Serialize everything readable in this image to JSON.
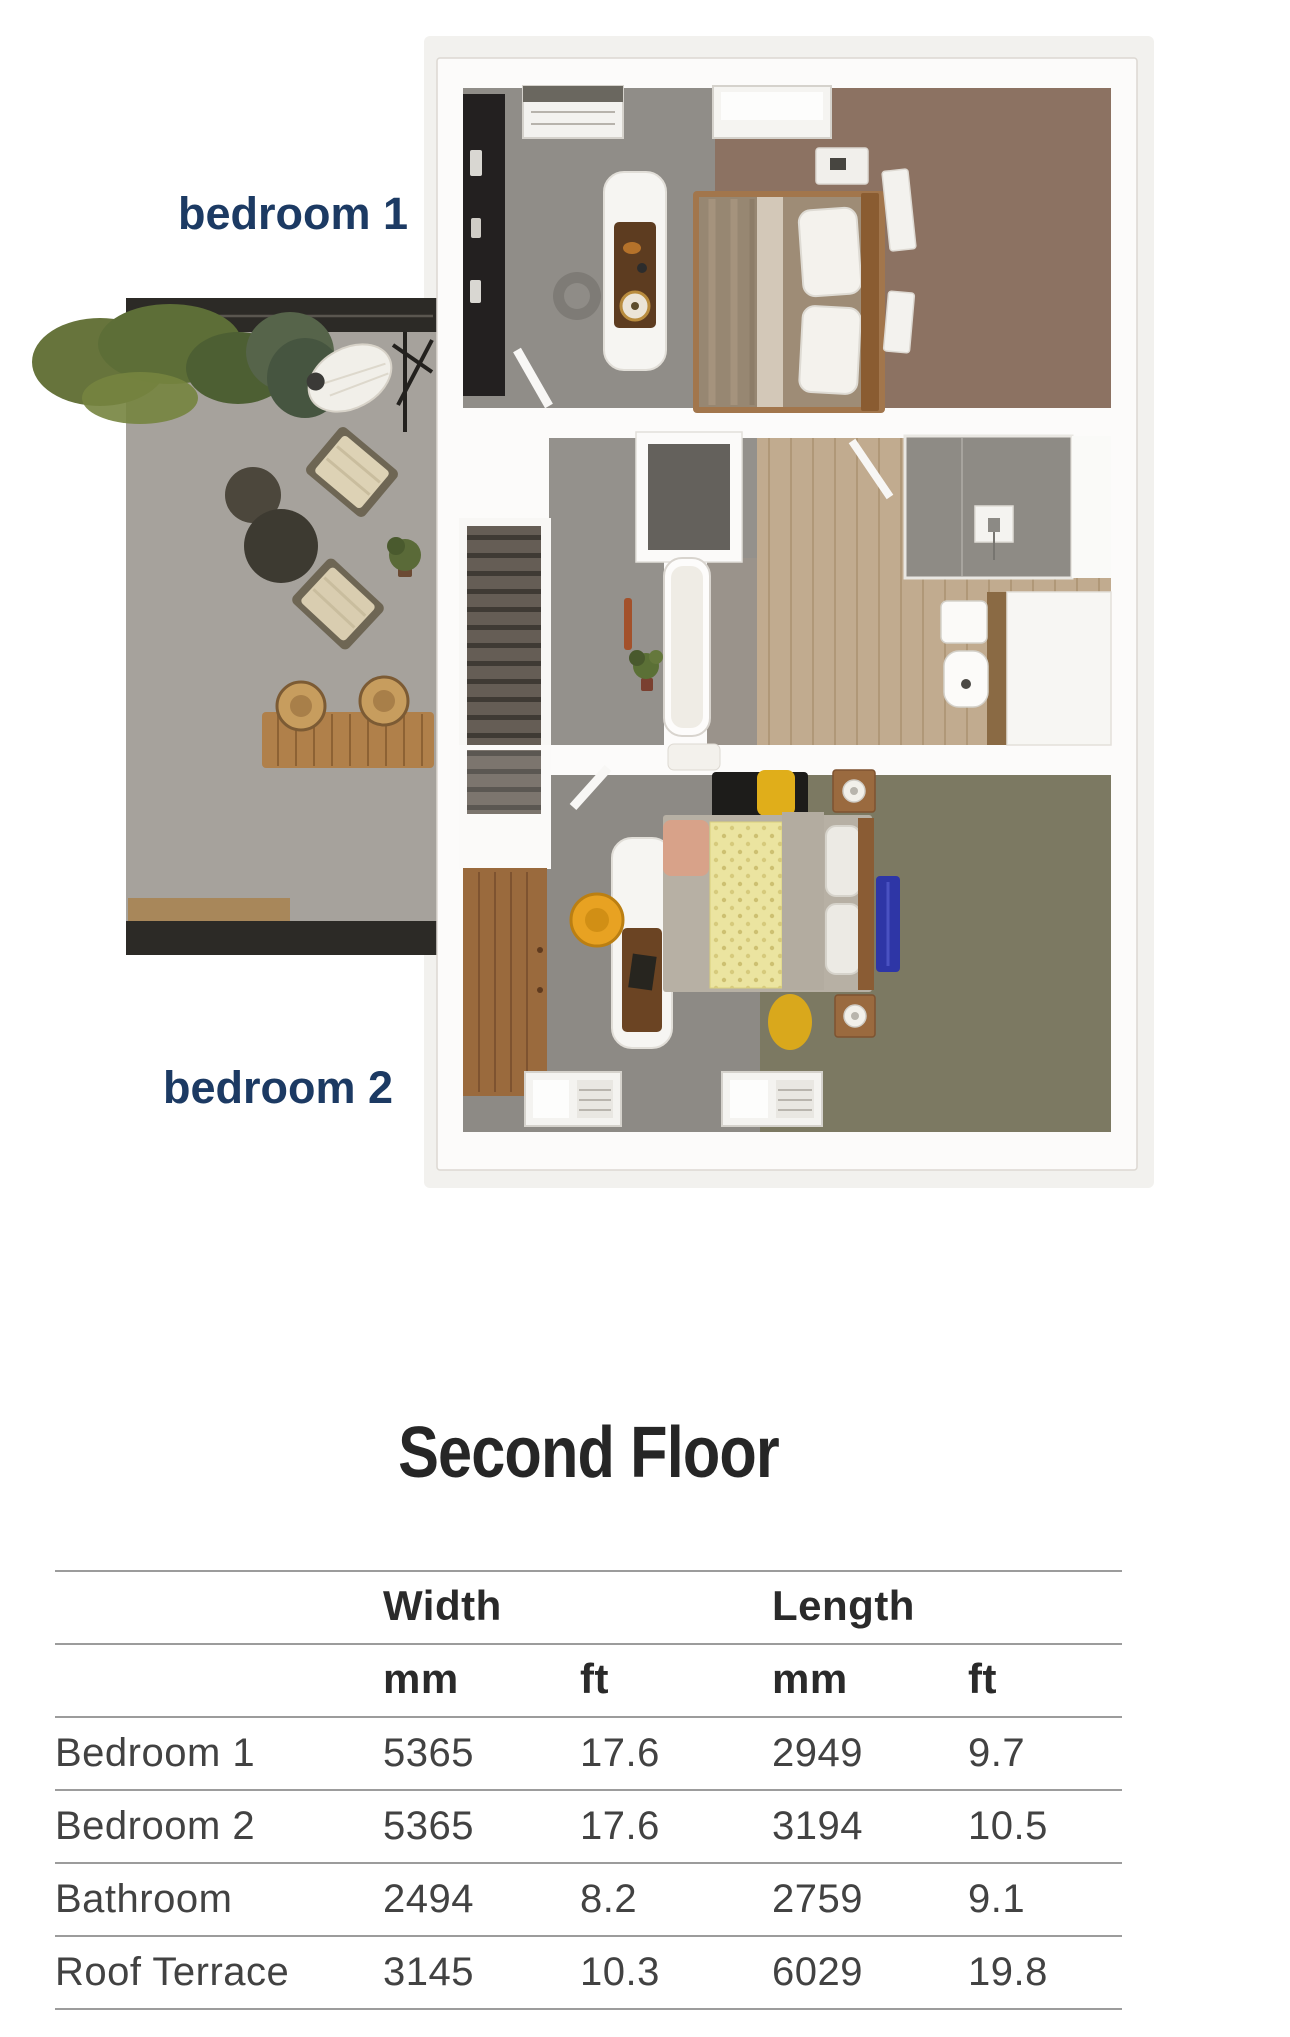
{
  "floor_plan": {
    "labels": {
      "bedroom1": "bedroom 1",
      "bedroom2": "bedroom 2"
    }
  },
  "title": "Second Floor",
  "table": {
    "group_headers": {
      "width": "Width",
      "length": "Length"
    },
    "unit_headers": {
      "width_mm": "mm",
      "width_ft": "ft",
      "length_mm": "mm",
      "length_ft": "ft"
    },
    "rows": [
      {
        "label": "Bedroom 1",
        "width_mm": "5365",
        "width_ft": "17.6",
        "length_mm": "2949",
        "length_ft": "9.7"
      },
      {
        "label": "Bedroom 2",
        "width_mm": "5365",
        "width_ft": "17.6",
        "length_mm": "3194",
        "length_ft": "10.5"
      },
      {
        "label": "Bathroom",
        "width_mm": "2494",
        "width_ft": "8.2",
        "length_mm": "2759",
        "length_ft": "9.1"
      },
      {
        "label": "Roof Terrace",
        "width_mm": "3145",
        "width_ft": "10.3",
        "length_mm": "6029",
        "length_ft": "19.8"
      }
    ]
  },
  "colors": {
    "label_navy": "#1c3a63",
    "title": "#262626",
    "rule_gray": "#9c9c9c",
    "table_text": "#424242",
    "terrace_floor": "#a6a29c",
    "terrace_band": "#2c2a26",
    "carpet_gray": "#908d88",
    "bedroom1_floor": "#8c7262",
    "bedroom2_floor": "#7c7962",
    "bathroom_floor": "#c1ab8f",
    "wood": "#9a6a3d",
    "bed2_yellow": "#ebe4a0",
    "chair_orange": "#e8a222",
    "rug_blue": "#2e36a6"
  }
}
